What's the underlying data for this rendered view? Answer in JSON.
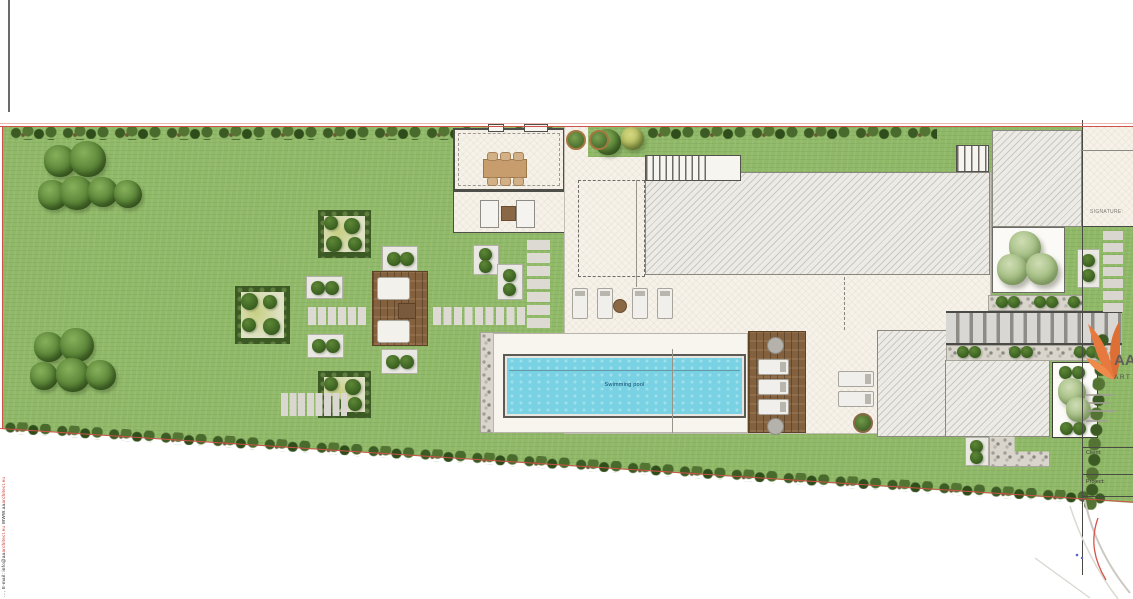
{
  "plan": {
    "pool_label": "Swimming pool"
  },
  "title_block": {
    "signature_label": "SIGNATURE:",
    "brand_initials": "AA",
    "brand_word": "ART",
    "client_label": "Client:",
    "project_label": "Project:"
  },
  "edge_note": {
    "lead": "…, ",
    "part1": "E-mail: info@aa",
    "domain1": "architect.eu",
    "part2": "  WWW.aa",
    "domain2": "architect.eu"
  },
  "colors": {
    "lawn": "#8fb867",
    "hedge": "#42612a",
    "terrace": "#f6f2ea",
    "roof": "#edebe6",
    "water": "#79d2e3",
    "wood": "#83613f",
    "red": "#cf5148",
    "orange": "#e8793e",
    "gravel": "#d9d5cc"
  }
}
